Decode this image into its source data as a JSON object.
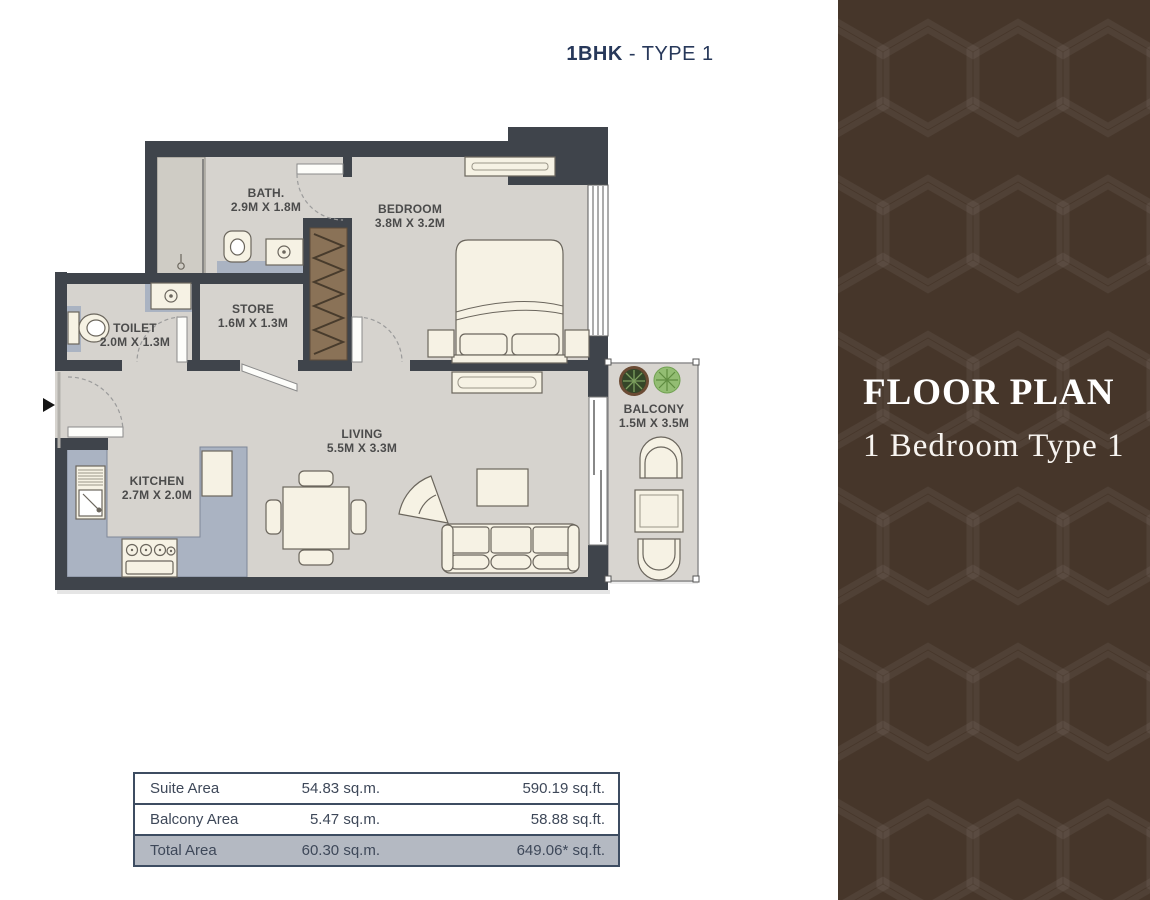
{
  "header": {
    "title_bold": "1BHK",
    "title_rest": " - TYPE 1"
  },
  "rooms": {
    "bath": {
      "name": "BATH.",
      "dims": "2.9M X 1.8M"
    },
    "bedroom": {
      "name": "BEDROOM",
      "dims": "3.8M X 3.2M"
    },
    "toilet": {
      "name": "TOILET",
      "dims": "2.0M X 1.3M"
    },
    "store": {
      "name": "STORE",
      "dims": "1.6M X 1.3M"
    },
    "kitchen": {
      "name": "KITCHEN",
      "dims": "2.7M X 2.0M"
    },
    "living": {
      "name": "LIVING",
      "dims": "5.5M X 3.3M"
    },
    "balcony": {
      "name": "BALCONY",
      "dims": "1.5M X 3.5M"
    }
  },
  "area_table": {
    "rows": [
      {
        "label": "Suite Area",
        "sqm": "54.83 sq.m.",
        "sqft": "590.19 sq.ft."
      },
      {
        "label": "Balcony Area",
        "sqm": "5.47 sq.m.",
        "sqft": "58.88 sq.ft."
      },
      {
        "label": "Total Area",
        "sqm": "60.30 sq.m.",
        "sqft": "649.06* sq.ft."
      }
    ]
  },
  "sidebar": {
    "heading": "FLOOR PLAN",
    "subheading": "1 Bedroom Type 1"
  },
  "icons": {
    "entry_arrow": "right-triangle",
    "plants": "potted-plants"
  },
  "colors": {
    "wall": "#3f444b",
    "floor": "#d6d3ce",
    "counter": "#aab3c2",
    "wardrobe": "#8a7257",
    "furniture": "#f6f2e4",
    "title_navy": "#27385a",
    "table_border": "#3d4c61",
    "table_total_bg": "#b4b9c2",
    "sidebar_bg": "#46362a"
  }
}
